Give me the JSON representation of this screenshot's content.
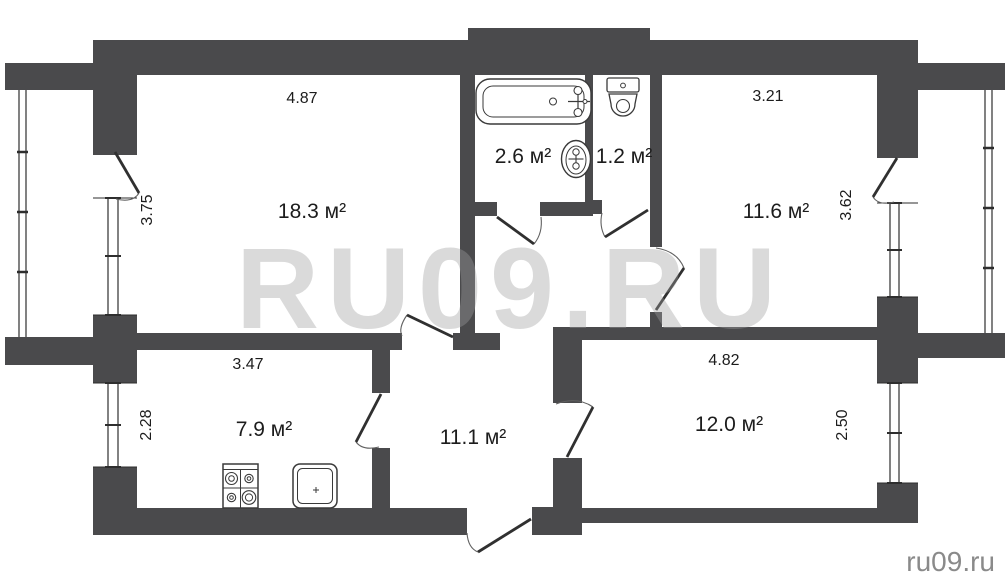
{
  "watermark": {
    "text": "RU09.RU",
    "color": "#a0a0a0",
    "opacity": 0.38
  },
  "site_credit": {
    "text": "ru09.ru",
    "color": "#8a8a8a"
  },
  "colors": {
    "wall": "#4a4a4c",
    "line": "#2e2e2e",
    "leaf": "#303030",
    "arc": "#606060",
    "bg": "#ffffff",
    "text": "#1c1c1c"
  },
  "plan": {
    "width": 1007,
    "height": 587,
    "room_labels": [
      {
        "name": "living-room-area",
        "text": "18.3 м²",
        "x": 312,
        "y": 218
      },
      {
        "name": "bathroom-area",
        "text": "2.6 м²",
        "x": 523,
        "y": 163
      },
      {
        "name": "wc-area",
        "text": "1.2 м²",
        "x": 624,
        "y": 163
      },
      {
        "name": "bedroom-area",
        "text": "11.6 м²",
        "x": 776,
        "y": 218
      },
      {
        "name": "kitchen-area",
        "text": "7.9 м²",
        "x": 264,
        "y": 436
      },
      {
        "name": "hallway-area",
        "text": "11.1 м²",
        "x": 473,
        "y": 444
      },
      {
        "name": "room12-area",
        "text": "12.0 м²",
        "x": 729,
        "y": 431
      }
    ],
    "dimension_labels": [
      {
        "name": "dim-4-87",
        "text": "4.87",
        "x": 302,
        "y": 103,
        "rotate": 0
      },
      {
        "name": "dim-3-75",
        "text": "3.75",
        "x": 152,
        "y": 210,
        "rotate": -90
      },
      {
        "name": "dim-3-21",
        "text": "3.21",
        "x": 768,
        "y": 101,
        "rotate": 0
      },
      {
        "name": "dim-3-62",
        "text": "3.62",
        "x": 851,
        "y": 205,
        "rotate": -90
      },
      {
        "name": "dim-3-47",
        "text": "3.47",
        "x": 248,
        "y": 369,
        "rotate": 0
      },
      {
        "name": "dim-2-28",
        "text": "2.28",
        "x": 151,
        "y": 425,
        "rotate": -90
      },
      {
        "name": "dim-4-82",
        "text": "4.82",
        "x": 724,
        "y": 365,
        "rotate": 0
      },
      {
        "name": "dim-2-50",
        "text": "2.50",
        "x": 847,
        "y": 425,
        "rotate": -90
      }
    ],
    "walls": [
      {
        "name": "top-wall",
        "x": 93,
        "y": 40,
        "w": 825,
        "h": 35
      },
      {
        "name": "top-wall-step",
        "x": 468,
        "y": 28,
        "w": 182,
        "h": 16
      },
      {
        "name": "left-corner-column",
        "x": 93,
        "y": 40,
        "w": 44,
        "h": 115
      },
      {
        "name": "right-corner-column",
        "x": 877,
        "y": 40,
        "w": 41,
        "h": 118
      },
      {
        "name": "left-wall-mid",
        "x": 93,
        "y": 315,
        "w": 44,
        "h": 52
      },
      {
        "name": "left-wall-seg",
        "x": 93,
        "y": 367,
        "w": 44,
        "h": 16
      },
      {
        "name": "left-wall-lower",
        "x": 93,
        "y": 467,
        "w": 44,
        "h": 68
      },
      {
        "name": "living-right-wall",
        "x": 460,
        "y": 75,
        "w": 15,
        "h": 275
      },
      {
        "name": "bath-wc-divider",
        "x": 585,
        "y": 75,
        "w": 8,
        "h": 130
      },
      {
        "name": "bath-door-jamb-left",
        "x": 475,
        "y": 202,
        "w": 22,
        "h": 14
      },
      {
        "name": "bath-door-jamb-right",
        "x": 540,
        "y": 202,
        "w": 53,
        "h": 14
      },
      {
        "name": "wc-door-jamb-left",
        "x": 593,
        "y": 200,
        "w": 9,
        "h": 14
      },
      {
        "name": "bedroom-left-wall",
        "x": 650,
        "y": 75,
        "w": 12,
        "h": 172
      },
      {
        "name": "bedroom-left-stub",
        "x": 650,
        "y": 312,
        "w": 12,
        "h": 28
      },
      {
        "name": "right-wall-mid",
        "x": 877,
        "y": 297,
        "w": 41,
        "h": 43
      },
      {
        "name": "mid-band-left",
        "x": 93,
        "y": 333,
        "w": 309,
        "h": 17
      },
      {
        "name": "mid-band-stub",
        "x": 453,
        "y": 333,
        "w": 47,
        "h": 17
      },
      {
        "name": "mid-band-right",
        "x": 553,
        "y": 327,
        "w": 365,
        "h": 13
      },
      {
        "name": "room12-left-wall-upper",
        "x": 553,
        "y": 340,
        "w": 29,
        "h": 63
      },
      {
        "name": "room12-left-wall-lower",
        "x": 553,
        "y": 458,
        "w": 29,
        "h": 50
      },
      {
        "name": "kitchen-right-wall-upper",
        "x": 372,
        "y": 350,
        "w": 18,
        "h": 43
      },
      {
        "name": "kitchen-right-wall-lower",
        "x": 372,
        "y": 448,
        "w": 18,
        "h": 60
      },
      {
        "name": "bottom-wall-left",
        "x": 93,
        "y": 508,
        "w": 374,
        "h": 27
      },
      {
        "name": "entrance-jamb",
        "x": 532,
        "y": 507,
        "w": 50,
        "h": 28
      },
      {
        "name": "bottom-wall-right",
        "x": 582,
        "y": 508,
        "w": 336,
        "h": 15
      },
      {
        "name": "room12-right-wall-upper",
        "x": 877,
        "y": 340,
        "w": 41,
        "h": 43
      },
      {
        "name": "room12-right-wall-lower",
        "x": 877,
        "y": 483,
        "w": 41,
        "h": 40
      },
      {
        "name": "balcony-left-top",
        "x": 5,
        "y": 63,
        "w": 90,
        "h": 27
      },
      {
        "name": "balcony-left-bottom",
        "x": 5,
        "y": 337,
        "w": 90,
        "h": 28
      },
      {
        "name": "balcony-right-top",
        "x": 918,
        "y": 63,
        "w": 87,
        "h": 27
      },
      {
        "name": "balcony-right-bottom",
        "x": 918,
        "y": 333,
        "w": 87,
        "h": 25
      }
    ],
    "windows": [
      {
        "name": "living-window",
        "x": 93,
        "y": 198,
        "w": 44,
        "h": 117,
        "lines": [
          108,
          118
        ],
        "ticks": [
          198,
          256,
          315
        ]
      },
      {
        "name": "kitchen-window",
        "x": 93,
        "y": 383,
        "w": 44,
        "h": 84,
        "lines": [
          108,
          118
        ],
        "ticks": [
          383,
          425,
          467
        ]
      },
      {
        "name": "bedroom-window",
        "x": 877,
        "y": 203,
        "w": 41,
        "h": 94,
        "lines": [
          890,
          899
        ],
        "ticks": [
          203,
          250,
          297
        ]
      },
      {
        "name": "room12-window",
        "x": 877,
        "y": 383,
        "w": 41,
        "h": 100,
        "lines": [
          890,
          899
        ],
        "ticks": [
          383,
          433,
          483
        ]
      }
    ],
    "glazing": [
      {
        "name": "balcony-left-glazing",
        "lines": [
          19,
          26
        ],
        "y1": 90,
        "y2": 337,
        "ticks": [
          152,
          212,
          272
        ]
      },
      {
        "name": "balcony-right-glazing",
        "lines": [
          985,
          992
        ],
        "y1": 90,
        "y2": 333,
        "ticks": [
          148,
          208,
          268
        ]
      }
    ],
    "doors": [
      {
        "name": "living-balcony-door",
        "leaf": [
          115,
          152,
          139,
          193
        ],
        "arc": "M139,193 Q133,203 116,199"
      },
      {
        "name": "living-hall-door",
        "leaf": [
          453,
          337,
          407,
          315
        ],
        "arc": "M407,315 Q398,328 402,336"
      },
      {
        "name": "bathroom-door",
        "leaf": [
          497,
          217,
          534,
          244
        ],
        "arc": "M534,244 Q543,233 541,217"
      },
      {
        "name": "wc-door",
        "leaf": [
          648,
          210,
          605,
          237
        ],
        "arc": "M605,237 Q599,226 602,213"
      },
      {
        "name": "bedroom-door",
        "leaf": [
          656,
          310,
          684,
          268
        ],
        "arc": "M656,248 Q677,251 684,268"
      },
      {
        "name": "kitchen-door",
        "leaf": [
          381,
          394,
          356,
          442
        ],
        "arc": "M356,442 Q363,451 379,447"
      },
      {
        "name": "room12-door",
        "leaf": [
          567,
          457,
          593,
          407
        ],
        "arc": "M556,404 Q577,396 593,407"
      },
      {
        "name": "entrance-door",
        "leaf": [
          531,
          519,
          478,
          552
        ],
        "arc": "M467,533 Q468,548 478,552"
      },
      {
        "name": "bedroom-balcony-door",
        "leaf": [
          897,
          158,
          873,
          197
        ],
        "arc": "M873,197 Q879,206 894,202"
      }
    ],
    "fixtures": [
      {
        "name": "bathtub",
        "type": "bathtub",
        "x": 476,
        "y": 79,
        "w": 115,
        "h": 45
      },
      {
        "name": "toilet",
        "type": "toilet",
        "x": 607,
        "y": 78
      },
      {
        "name": "bathroom-sink",
        "type": "oval-sink",
        "cx": 576,
        "cy": 159
      },
      {
        "name": "stove",
        "type": "stove",
        "x": 223,
        "y": 464,
        "w": 35,
        "h": 44
      },
      {
        "name": "kitchen-sink",
        "type": "kitchen-sink",
        "x": 293,
        "y": 464,
        "w": 44,
        "h": 44
      }
    ]
  }
}
